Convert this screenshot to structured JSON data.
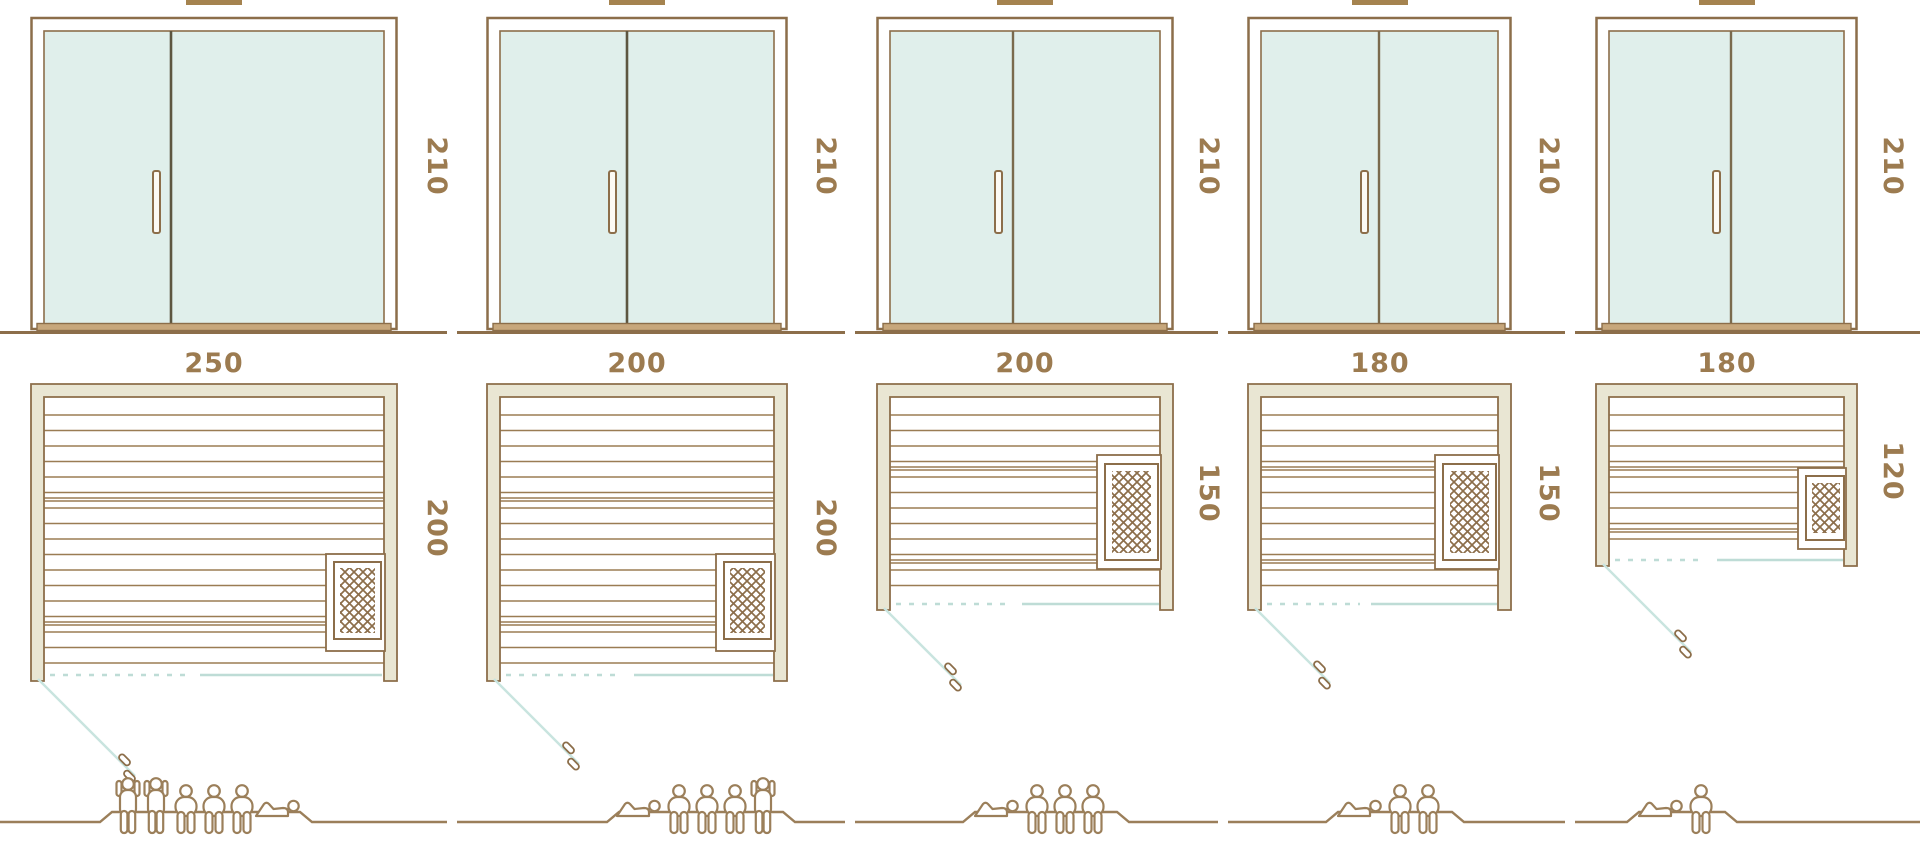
{
  "diagram_type": "sauna-size-comparison",
  "columns": [
    {
      "width_cm": "250",
      "depth_cm": "200",
      "height_cm": "210",
      "capacity": {
        "standing": 2,
        "sitting": 3,
        "lying": 1,
        "poses": [
          "stand",
          "stand",
          "sit",
          "sit",
          "sit",
          "lie"
        ]
      }
    },
    {
      "width_cm": "200",
      "depth_cm": "200",
      "height_cm": "210",
      "capacity": {
        "standing": 1,
        "sitting": 3,
        "lying": 1,
        "poses": [
          "lie",
          "sit",
          "sit",
          "sit",
          "stand"
        ]
      }
    },
    {
      "width_cm": "200",
      "depth_cm": "150",
      "height_cm": "210",
      "capacity": {
        "standing": 0,
        "sitting": 3,
        "lying": 1,
        "poses": [
          "lie",
          "sit",
          "sit",
          "sit"
        ]
      }
    },
    {
      "width_cm": "180",
      "depth_cm": "150",
      "height_cm": "210",
      "capacity": {
        "standing": 0,
        "sitting": 2,
        "lying": 1,
        "poses": [
          "lie",
          "sit",
          "sit"
        ]
      }
    },
    {
      "width_cm": "180",
      "depth_cm": "120",
      "height_cm": "210",
      "capacity": {
        "standing": 0,
        "sitting": 1,
        "lying": 1,
        "poses": [
          "lie",
          "sit"
        ]
      }
    }
  ],
  "colors": {
    "line": "#8c6e4a",
    "text": "#9c7b50",
    "glass": "#e0efeb",
    "wall": "#e9e6d3",
    "threshold": "#c7a77c",
    "teal": "#c9e4df",
    "figure": "#9b7f5a"
  }
}
